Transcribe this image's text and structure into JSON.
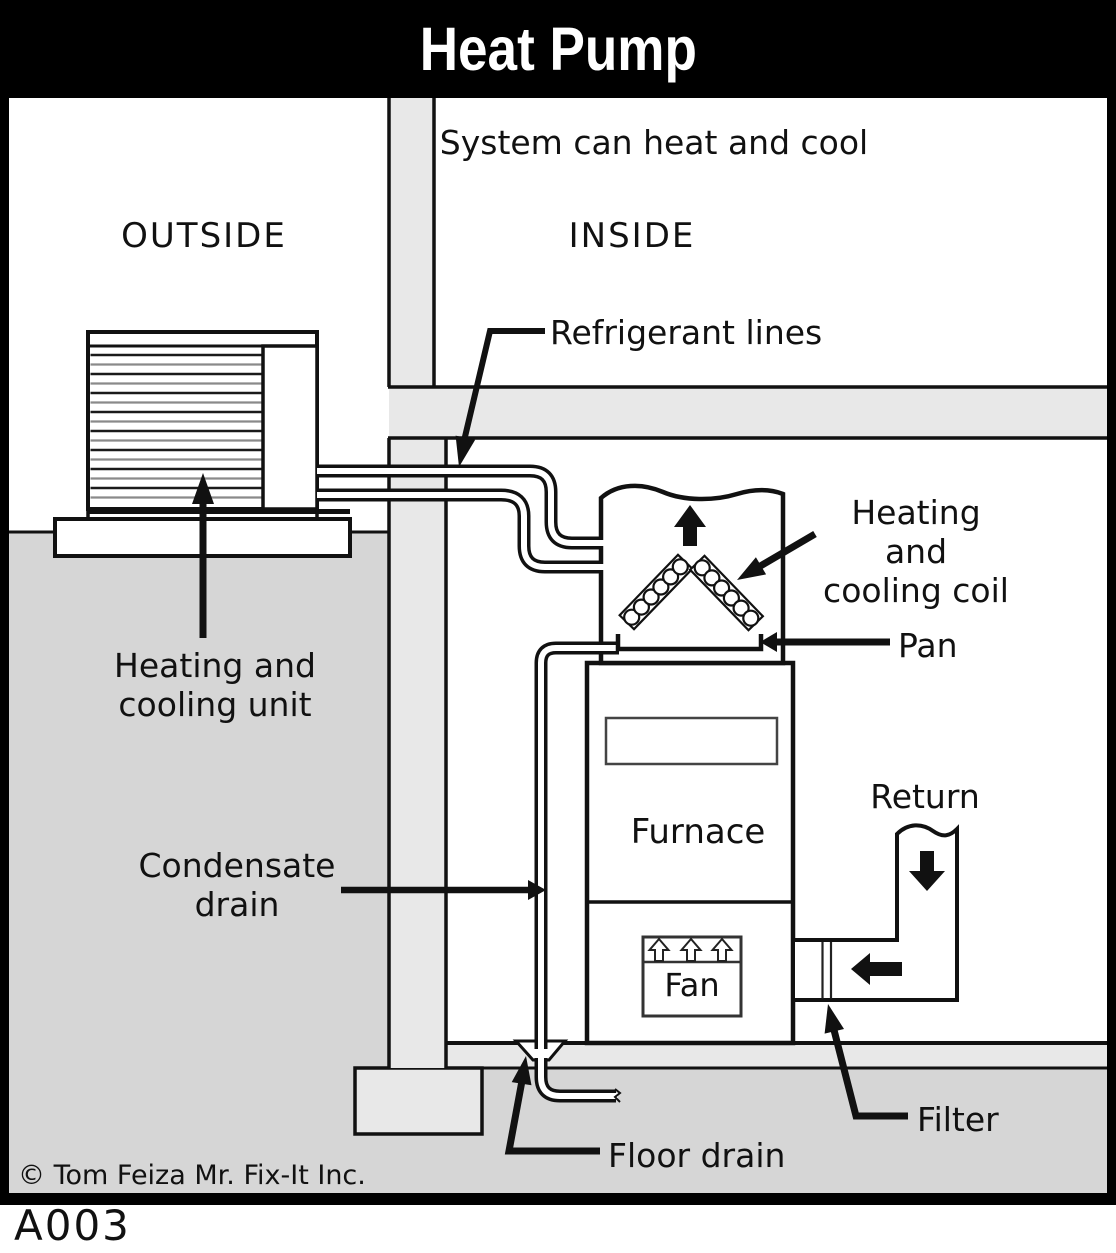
{
  "title": "Heat Pump",
  "code": "A003",
  "copyright": "© Tom Feiza Mr. Fix-It Inc.",
  "regions": {
    "subtitle": "System can heat and cool",
    "outside": "OUTSIDE",
    "inside": "INSIDE"
  },
  "labels": {
    "refrigerant_lines": "Refrigerant lines",
    "heating_cooling_coil": "Heating and\ncooling coil",
    "pan": "Pan",
    "heating_cooling_unit": "Heating and\ncooling unit",
    "furnace": "Furnace",
    "return_duct": "Return",
    "condensate_drain": "Condensate\ndrain",
    "fan": "Fan",
    "filter": "Filter",
    "floor_drain": "Floor drain"
  },
  "colors": {
    "titlebar": "#000000",
    "ground": "#d6d6d6",
    "wall": "#e8e8e8",
    "line": "#111111",
    "white": "#ffffff"
  }
}
